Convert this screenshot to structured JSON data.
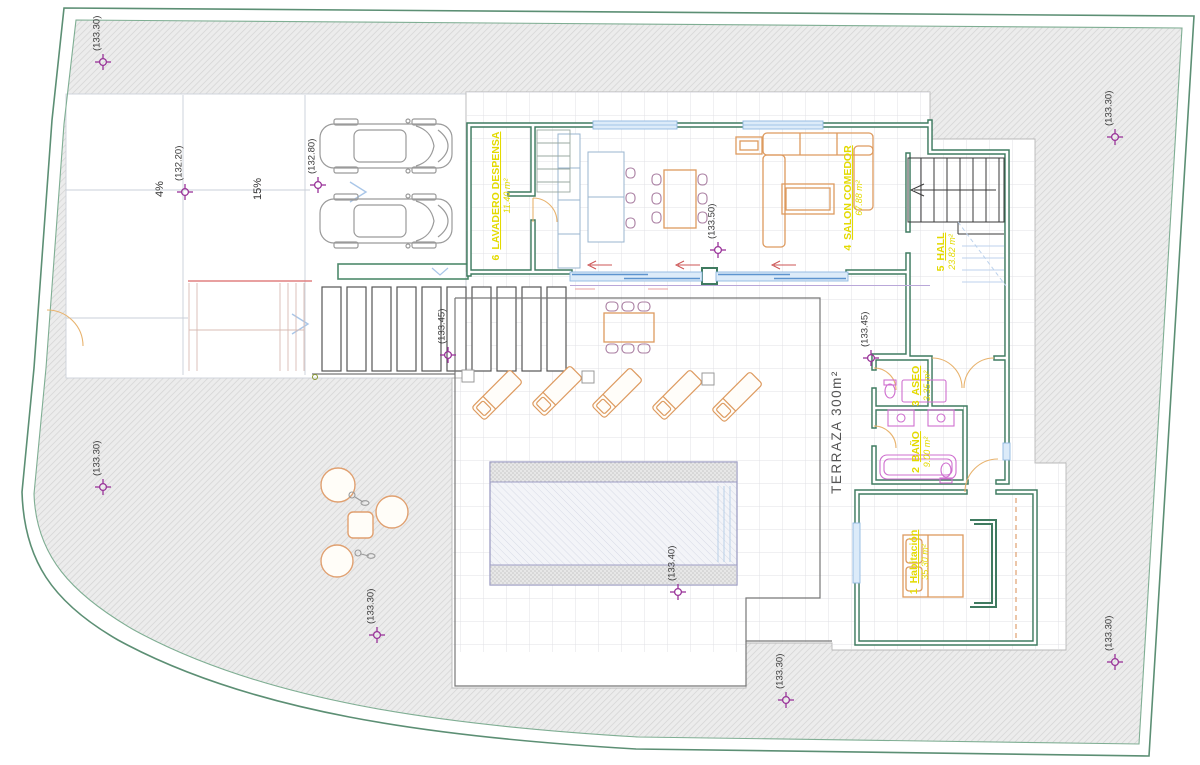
{
  "colors": {
    "boundary_green": "#5c8f74",
    "wall_green": "#3f7b60",
    "furniture_orange": "#dd9a5f",
    "fixture_magenta": "#cf6fcf",
    "label_yellow": "#e3da00",
    "marker_purple": "#993399",
    "window_blue": "#7fb2e5",
    "terrace_text_gray": "#555555"
  },
  "markers": [
    {
      "id": "site-northwest",
      "label": "(133.30)"
    },
    {
      "id": "driveway-upper",
      "label": "(132.20)"
    },
    {
      "id": "parking",
      "label": "(132.80)"
    },
    {
      "id": "kitchen-dining",
      "label": "(133.50)"
    },
    {
      "id": "pergola",
      "label": "(133.45)"
    },
    {
      "id": "hall-corner",
      "label": "(133.45)"
    },
    {
      "id": "pool-side",
      "label": "(133.40)"
    },
    {
      "id": "site-west",
      "label": "(133.30)"
    },
    {
      "id": "site-southwest",
      "label": "(133.30)"
    },
    {
      "id": "site-south",
      "label": "(133.30)"
    },
    {
      "id": "site-southeast",
      "label": "(133.30)"
    },
    {
      "id": "site-northeast",
      "label": "(133.30)"
    }
  ],
  "slopes": {
    "ramp1": "4%",
    "ramp2": "15%"
  },
  "terrace_label": "TERRAZA 300m²",
  "rooms": {
    "habitacion": {
      "number": "1",
      "name": "Habitación",
      "area": "35.30 m²"
    },
    "bano": {
      "number": "2",
      "name": "BAÑO",
      "area": "9.00 m²"
    },
    "aseo": {
      "number": "3",
      "name": "ASEO",
      "area": "3.35 m²"
    },
    "salon": {
      "number": "4",
      "name": "SALON COMEDOR",
      "area": "67.88 m²"
    },
    "hall": {
      "number": "5",
      "name": "HALL",
      "area": "23.82 m²"
    },
    "lavadero": {
      "number": "6",
      "name": "LAVADERO DESPENSA",
      "area": "11.40 m²"
    }
  }
}
